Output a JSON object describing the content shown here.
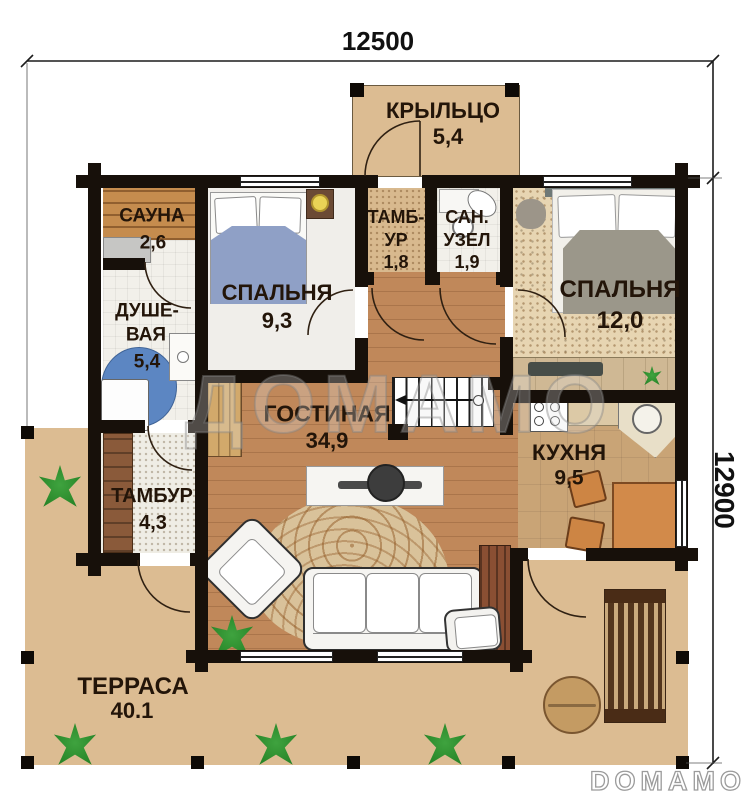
{
  "dimensions": {
    "top": "12500",
    "right": "12900"
  },
  "watermark": {
    "text": "ДОМАМО"
  },
  "brand": {
    "logo_text": "DOMAMO"
  },
  "rooms": [
    {
      "id": "porch",
      "lines": [
        "КРЫЛЬЦО"
      ],
      "area": "5,4"
    },
    {
      "id": "sauna",
      "lines": [
        "САУНА"
      ],
      "area": "2,6"
    },
    {
      "id": "bedroom-1",
      "lines": [
        "СПАЛЬНЯ"
      ],
      "area": "9,3"
    },
    {
      "id": "entry",
      "lines": [
        "ТАМБ-",
        "УР"
      ],
      "area": "1,8"
    },
    {
      "id": "wc",
      "lines": [
        "САН.",
        "УЗЕЛ"
      ],
      "area": "1,9"
    },
    {
      "id": "bedroom-2",
      "lines": [
        "СПАЛЬНЯ"
      ],
      "area": "12,0"
    },
    {
      "id": "shower",
      "lines": [
        "ДУШЕ-",
        "ВАЯ"
      ],
      "area": "5,4"
    },
    {
      "id": "living",
      "lines": [
        "ГОСТИНАЯ"
      ],
      "area": "34,9"
    },
    {
      "id": "kitchen",
      "lines": [
        "КУХНЯ"
      ],
      "area": "9,5"
    },
    {
      "id": "tambour",
      "lines": [
        "ТАМБУР"
      ],
      "area": "4,3"
    },
    {
      "id": "terrace",
      "lines": [
        "ТЕРРАСА"
      ],
      "area": "40.1"
    }
  ],
  "palette": {
    "wall": "#17100a",
    "terrace_floor": "#dcbc92",
    "living_floor": "#c0885a",
    "kitchen_floor": "#c9a476",
    "bedroom_carpet": "#e7d5b2",
    "tile_floor": "#f2f0ea",
    "sauna_wood": "#c58c4e",
    "blanket_blue": "#8fa0c6",
    "blanket_gray": "#9b9789",
    "shower_blue": "#5c86c2",
    "furniture_orange": "#d28a4a",
    "plant_green": "#2e8b2e"
  }
}
